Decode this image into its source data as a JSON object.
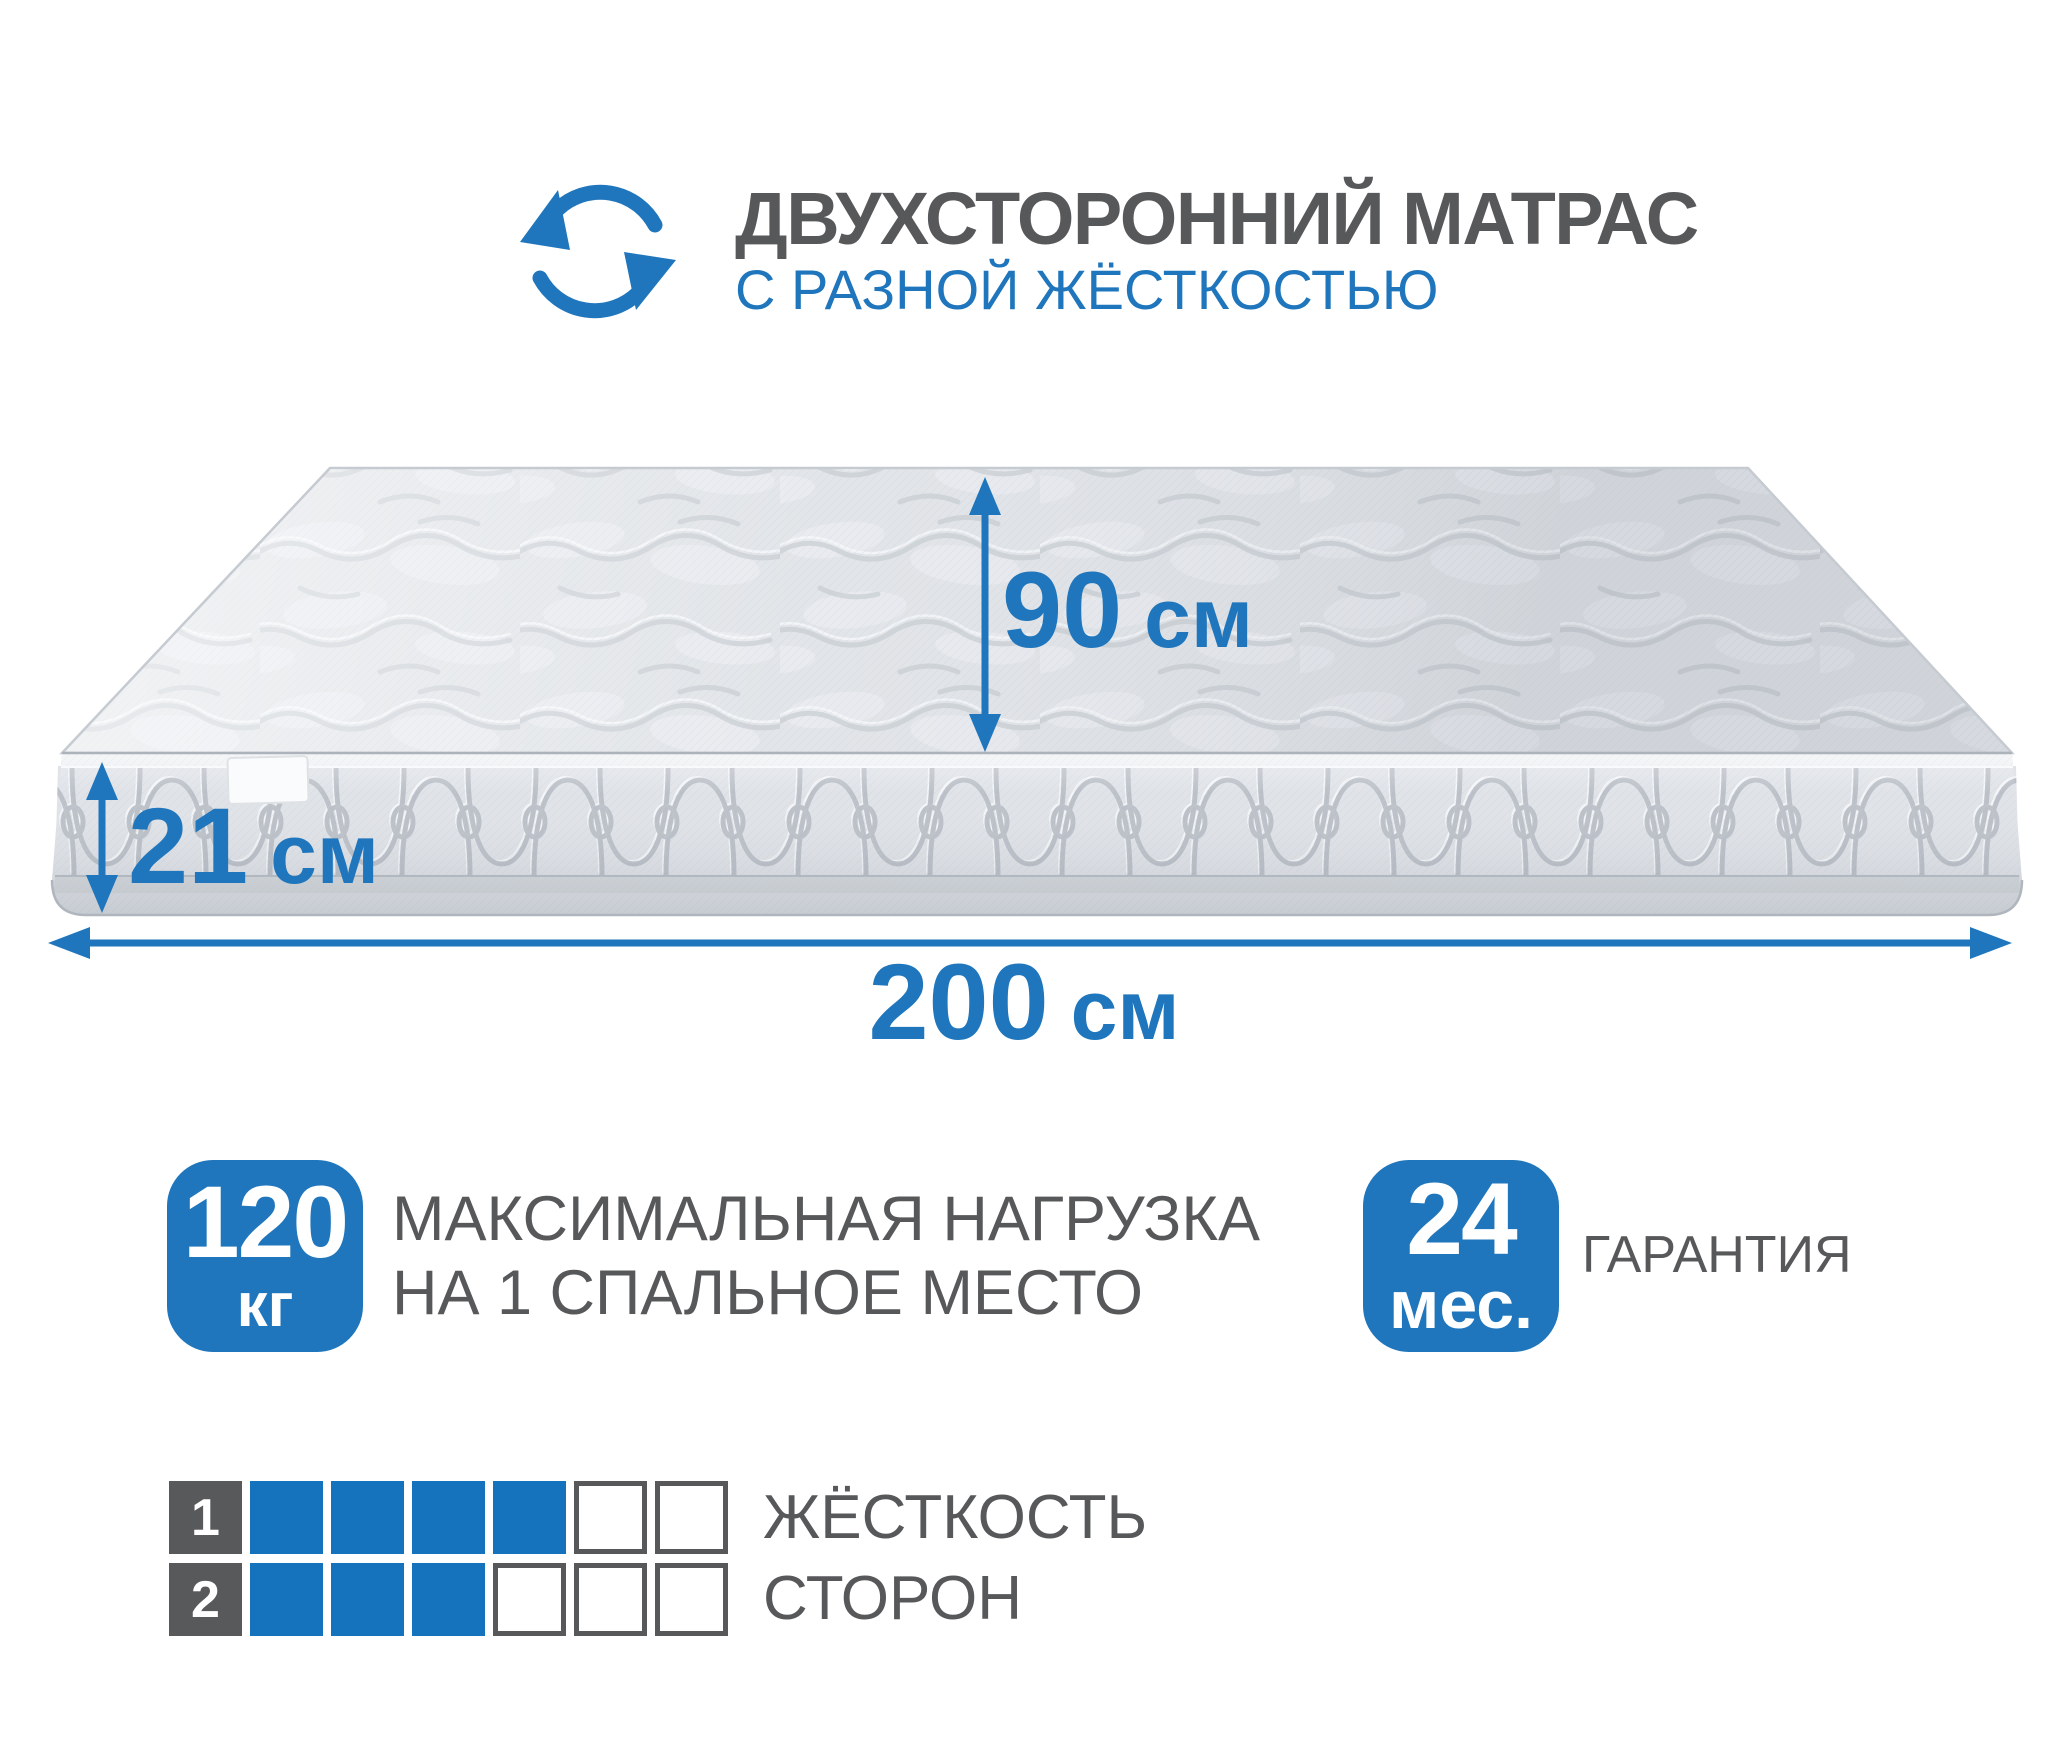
{
  "page": {
    "background": "#ffffff"
  },
  "colors": {
    "accent_blue": "#1f76bc",
    "text_gray": "#57585a",
    "firmness_square_blue": "#1573bd",
    "firmness_label_square_gray": "#58595b",
    "mattress_light_gray": "#e1e4e8",
    "mattress_stitch_gray": "#b7bdc5"
  },
  "header": {
    "icon": "rotate-arrows-icon",
    "title": "ДВУХСТОРОННИЙ МАТРАС",
    "subtitle": "С РАЗНОЙ ЖЁСТКОСТЬЮ"
  },
  "dimensions": {
    "width": {
      "value": "90",
      "unit": "см"
    },
    "height": {
      "value": "21",
      "unit": "см"
    },
    "length": {
      "value": "200",
      "unit": "см"
    }
  },
  "features": {
    "max_load": {
      "badge_value": "120",
      "badge_unit": "кг",
      "label_line1": "МАКСИМАЛЬНАЯ НАГРУЗКА",
      "label_line2": "НА 1 СПАЛЬНОЕ МЕСТО"
    },
    "warranty": {
      "badge_value": "24",
      "badge_unit": "мес.",
      "label": "ГАРАНТИЯ"
    }
  },
  "firmness": {
    "label_line1": "ЖЁСТКОСТЬ",
    "label_line2": "СТОРОН",
    "scale_max": 6,
    "rows": [
      {
        "side": "1",
        "filled": 4
      },
      {
        "side": "2",
        "filled": 3
      }
    ]
  }
}
